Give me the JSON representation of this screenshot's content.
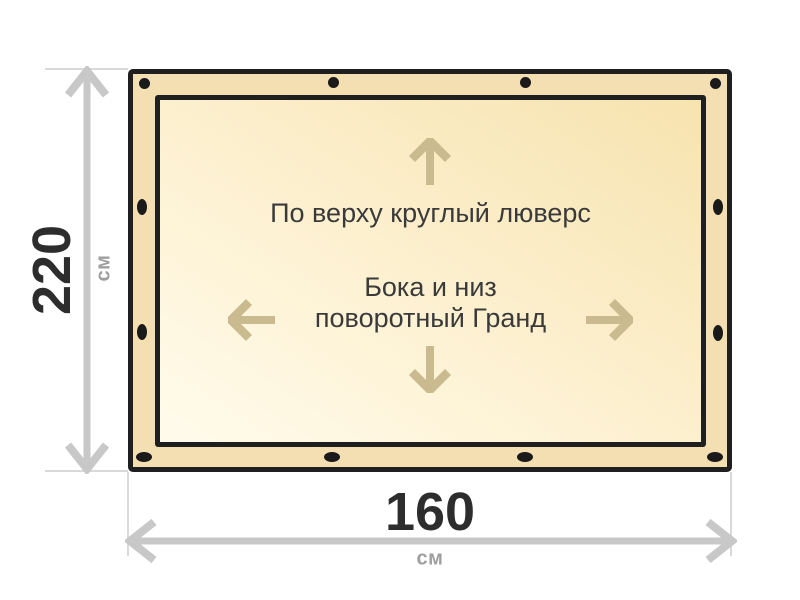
{
  "diagram": {
    "kind": "banner-size-diagram",
    "notes": {
      "top": "По верху круглый люверс",
      "center_line1": "Бока и низ",
      "center_line2": "поворотный Гранд"
    },
    "dimensions": {
      "height": {
        "value": "220",
        "unit": "см"
      },
      "width": {
        "value": "160",
        "unit": "см"
      }
    },
    "grommets": {
      "top_count": 4,
      "top_shape": "round",
      "left_count": 2,
      "right_count": 2,
      "side_shape": "vertical-oval",
      "bottom_count": 4,
      "bottom_shape": "horizontal-oval"
    },
    "colors": {
      "band": "#F3DFB1",
      "inner_light": "#FFFAE9",
      "inner_dark": "#F7E3AF",
      "border": "#1F1F1F",
      "grommet": "#1A1A1A",
      "inner_arrow": "#C9BA8F",
      "dimension_arrow": "#C8C8C8",
      "extension_line": "#D9D9D9",
      "dimension_text": "#2D2D2D",
      "unit_text": "#9E9E9E",
      "note_text": "#3A3A3A",
      "background": "#FFFFFF"
    }
  }
}
